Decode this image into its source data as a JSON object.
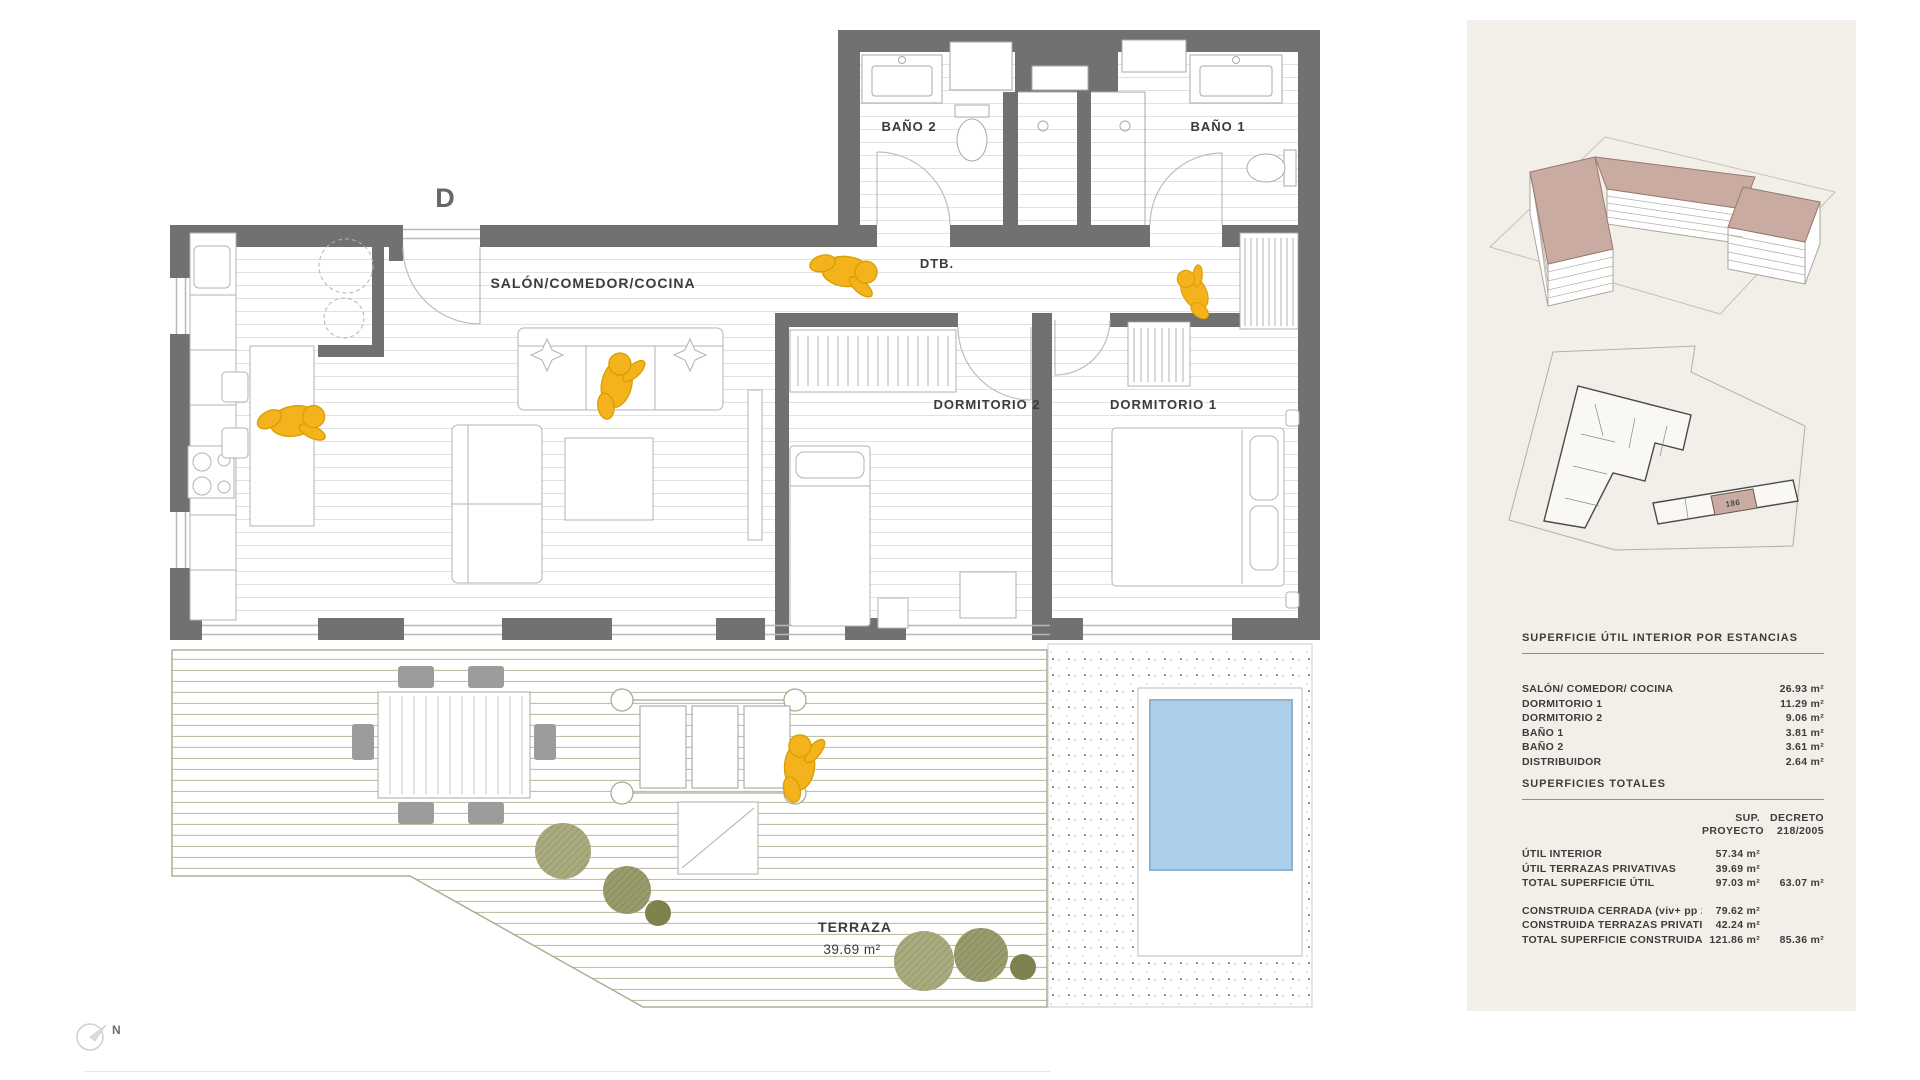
{
  "plan": {
    "unit_letter": "D",
    "rooms": {
      "salon": "SALÓN/COMEDOR/COCINA",
      "bano2": "BAÑO 2",
      "bano1": "BAÑO 1",
      "dtb": "DTB.",
      "dorm2": "DORMITORIO 2",
      "dorm1": "DORMITORIO 1",
      "terraza": "TERRAZA",
      "terraza_area": "39.69 m²"
    },
    "north_label": "N"
  },
  "sidebar": {
    "site_plan_unit_label": "186",
    "room_table": {
      "title": "SUPERFICIE ÚTIL INTERIOR POR ESTANCIAS",
      "rows": [
        {
          "label": "SALÓN/ COMEDOR/ COCINA",
          "value": "26.93 m²"
        },
        {
          "label": "DORMITORIO 1",
          "value": "11.29 m²"
        },
        {
          "label": "DORMITORIO 2",
          "value": "9.06 m²"
        },
        {
          "label": "BAÑO 1",
          "value": "3.81 m²"
        },
        {
          "label": "BAÑO 2",
          "value": "3.61 m²"
        },
        {
          "label": "DISTRIBUIDOR",
          "value": "2.64 m²"
        }
      ]
    },
    "totals_table": {
      "title": "SUPERFICIES TOTALES",
      "col1_line1": "SUP.",
      "col1_line2": "PROYECTO",
      "col2_line1": "DECRETO",
      "col2_line2": "218/2005",
      "rows": [
        {
          "label": "ÚTIL INTERIOR",
          "proyecto": "57.34 m²",
          "decreto": ""
        },
        {
          "label": "ÚTIL TERRAZAS PRIVATIVAS",
          "proyecto": "39.69 m²",
          "decreto": ""
        },
        {
          "label": "TOTAL SUPERFICIE ÚTIL",
          "proyecto": "97.03 m²",
          "decreto": "63.07 m²"
        },
        {
          "label": "CONSTRUIDA CERRADA (viv+ pp zzcc)",
          "proyecto": "79.62 m²",
          "decreto": ""
        },
        {
          "label": "CONSTRUIDA TERRAZAS PRIVATIVAS",
          "proyecto": "42.24 m²",
          "decreto": ""
        },
        {
          "label": "TOTAL SUPERFICIE CONSTRUIDA",
          "proyecto": "121.86 m²",
          "decreto": "85.36 m²"
        }
      ]
    }
  },
  "colors": {
    "wall": "#717171",
    "figure_accent": "#F4B31C",
    "pool": "#ABCFEA",
    "roof_highlight": "#C9ABA1",
    "sidebar_bg": "#F2EFE9",
    "bush_olive": "#999B6C"
  }
}
